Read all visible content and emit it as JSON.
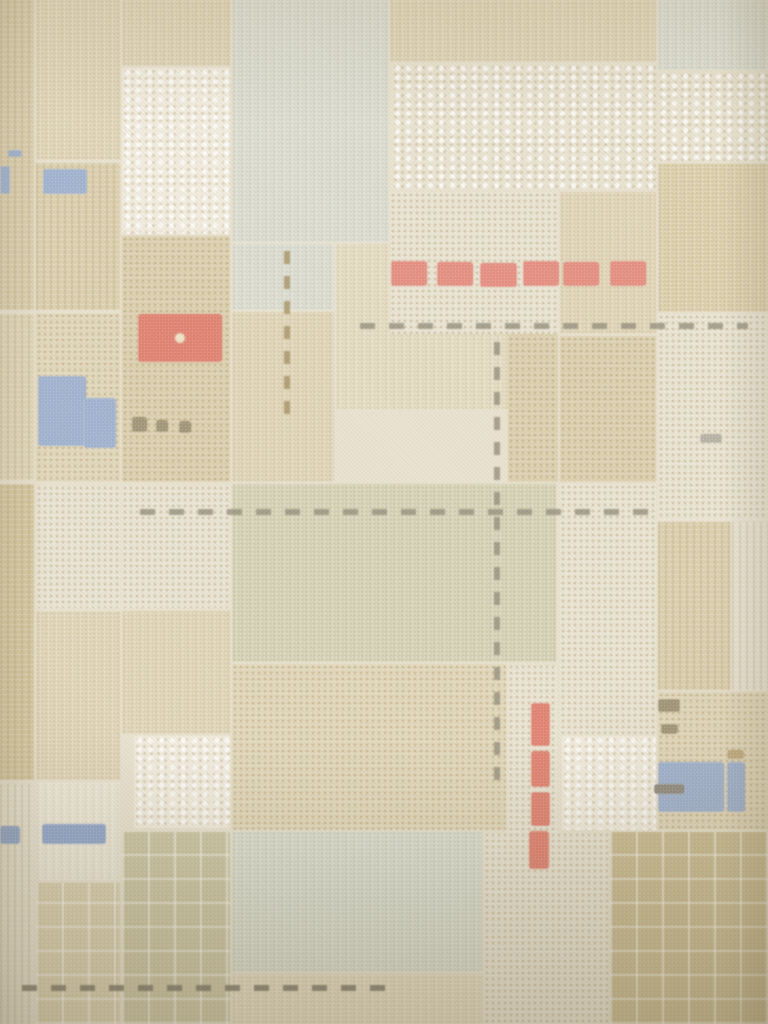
{
  "meta": {
    "subject": "vintage patchwork plaid wallpaper photograph with stitched accent motifs"
  },
  "palette": {
    "base": "#e9e2d0",
    "tan": "#dbcfae",
    "tan_light": "#e0d6b9",
    "olive": "#d6c8a1",
    "olive_dark": "#cfc29b",
    "beige": "#ded5b8",
    "sage": "#d0cbac",
    "bluegray": "#d6d8cb",
    "bluegreen": "#d3d7c8",
    "cream": "#e9e3d2",
    "white": "#f1ecdf",
    "red": "#df7868",
    "red_deep": "#da6a57",
    "blue": "#8ea3c6",
    "blue_deep": "#7d95bf",
    "stitch_gray": "#96907e",
    "stitch_dark": "#7b7566",
    "stitch_brown": "#a79366",
    "olive_mark": "#8d805d",
    "tan_mark": "#b49a66",
    "gray_mark": "#a7a294"
  },
  "scene": {
    "width": 768,
    "height": 1024,
    "background": "base"
  },
  "patches": [
    {
      "name": "left-column-top",
      "c": "tan",
      "tx": "stripes",
      "x": 0,
      "y": 0,
      "w": 34,
      "h": 310
    },
    {
      "name": "left-column-mid",
      "c": "tan_light",
      "tx": "stripes",
      "x": 0,
      "y": 314,
      "w": 34,
      "h": 166
    },
    {
      "name": "left-column-olive",
      "c": "olive",
      "tx": "stripes",
      "x": 0,
      "y": 484,
      "w": 34,
      "h": 296
    },
    {
      "name": "left-column-bottom",
      "c": "cream",
      "tx": "stripes",
      "x": 0,
      "y": 784,
      "w": 34,
      "h": 240
    },
    {
      "name": "col1-top",
      "c": "tan",
      "tx": "grid",
      "x": 36,
      "y": 0,
      "w": 84,
      "h": 160
    },
    {
      "name": "col1-blue-row",
      "c": "tan",
      "tx": "stripes",
      "x": 36,
      "y": 163,
      "w": 84,
      "h": 147
    },
    {
      "name": "col1-mid",
      "c": "tan_light",
      "tx": "dots",
      "x": 36,
      "y": 313,
      "w": 84,
      "h": 169
    },
    {
      "name": "col1-cream",
      "c": "cream",
      "tx": "dots",
      "x": 36,
      "y": 485,
      "w": 84,
      "h": 123
    },
    {
      "name": "col1-low",
      "c": "tan",
      "tx": "grid",
      "x": 36,
      "y": 611,
      "w": 84,
      "h": 169
    },
    {
      "name": "col1-pale",
      "c": "cream",
      "tx": "grid",
      "x": 36,
      "y": 783,
      "w": 84,
      "h": 97
    },
    {
      "name": "col1-bottom",
      "c": "beige",
      "tx": "plaid",
      "x": 36,
      "y": 883,
      "w": 84,
      "h": 141
    },
    {
      "name": "col2-top",
      "c": "tan",
      "tx": "grid",
      "x": 122,
      "y": 0,
      "w": 108,
      "h": 66
    },
    {
      "name": "col2-lace",
      "c": "white",
      "tx": "lace",
      "x": 122,
      "y": 68,
      "w": 108,
      "h": 166
    },
    {
      "name": "col2-mid",
      "c": "tan",
      "tx": "dots",
      "x": 122,
      "y": 236,
      "w": 108,
      "h": 246
    },
    {
      "name": "col2-cream",
      "c": "cream",
      "tx": "dots",
      "x": 122,
      "y": 485,
      "w": 108,
      "h": 123
    },
    {
      "name": "col2-low",
      "c": "tan",
      "tx": "grid",
      "x": 122,
      "y": 611,
      "w": 108,
      "h": 123
    },
    {
      "name": "col2-white-lace",
      "c": "white",
      "tx": "lace",
      "x": 134,
      "y": 736,
      "w": 96,
      "h": 92
    },
    {
      "name": "col2-bottom",
      "c": "sage",
      "tx": "plaid",
      "x": 122,
      "y": 832,
      "w": 108,
      "h": 192
    },
    {
      "name": "top-bluegray",
      "c": "bluegray",
      "tx": "grid",
      "x": 232,
      "y": 0,
      "w": 156,
      "h": 242
    },
    {
      "name": "bluegray-ext",
      "c": "bluegray",
      "tx": "grid",
      "x": 232,
      "y": 244,
      "w": 102,
      "h": 66
    },
    {
      "name": "mid-tan-row",
      "c": "tan_light",
      "tx": "grid",
      "x": 336,
      "y": 244,
      "w": 172,
      "h": 166
    },
    {
      "name": "mid-tan-left",
      "c": "tan",
      "tx": "grid",
      "x": 232,
      "y": 312,
      "w": 102,
      "h": 170
    },
    {
      "name": "sage-big",
      "c": "sage",
      "tx": "grid",
      "x": 232,
      "y": 484,
      "w": 324,
      "h": 178
    },
    {
      "name": "mid-tan-low",
      "c": "tan_light",
      "tx": "dots",
      "x": 232,
      "y": 664,
      "w": 274,
      "h": 166
    },
    {
      "name": "strip-mid",
      "c": "tan",
      "tx": "dots",
      "x": 508,
      "y": 312,
      "w": 50,
      "h": 170
    },
    {
      "name": "strip-mid-low",
      "c": "cream",
      "tx": "dots",
      "x": 508,
      "y": 664,
      "w": 50,
      "h": 216
    },
    {
      "name": "col4-top",
      "c": "tan",
      "tx": "grid",
      "x": 560,
      "y": 192,
      "w": 96,
      "h": 142
    },
    {
      "name": "col4-mid",
      "c": "tan",
      "tx": "dots",
      "x": 560,
      "y": 336,
      "w": 96,
      "h": 146
    },
    {
      "name": "col4-cream",
      "c": "cream",
      "tx": "dots",
      "x": 560,
      "y": 484,
      "w": 96,
      "h": 250
    },
    {
      "name": "col4-lace",
      "c": "white",
      "tx": "lace",
      "x": 562,
      "y": 736,
      "w": 94,
      "h": 94
    },
    {
      "name": "bottom-bluegreen",
      "c": "bluegreen",
      "tx": "grid",
      "x": 232,
      "y": 832,
      "w": 250,
      "h": 140
    },
    {
      "name": "bottom-strip",
      "c": "tan_light",
      "tx": "grid",
      "x": 232,
      "y": 974,
      "w": 250,
      "h": 50
    },
    {
      "name": "bottom-cream",
      "c": "cream",
      "tx": "dots",
      "x": 484,
      "y": 832,
      "w": 124,
      "h": 192
    },
    {
      "name": "red-row-bg",
      "c": "cream",
      "tx": "dots",
      "x": 390,
      "y": 192,
      "w": 168,
      "h": 142
    },
    {
      "name": "top-tan-row",
      "c": "tan",
      "tx": "grid",
      "x": 390,
      "y": 0,
      "w": 266,
      "h": 62
    },
    {
      "name": "top-lace",
      "c": "cream",
      "tx": "lace",
      "x": 392,
      "y": 64,
      "w": 264,
      "h": 126
    },
    {
      "name": "topright-corner",
      "c": "bluegray",
      "tx": "grid",
      "x": 658,
      "y": 0,
      "w": 110,
      "h": 70
    },
    {
      "name": "right-lace-1",
      "c": "cream",
      "tx": "lace",
      "x": 658,
      "y": 72,
      "w": 110,
      "h": 90
    },
    {
      "name": "right-olive",
      "c": "olive",
      "tx": "grid",
      "x": 658,
      "y": 164,
      "w": 110,
      "h": 148
    },
    {
      "name": "right-lace-2",
      "c": "cream",
      "tx": "dots",
      "x": 658,
      "y": 314,
      "w": 110,
      "h": 206
    },
    {
      "name": "right-strip-1",
      "c": "tan",
      "tx": "stripes",
      "x": 658,
      "y": 522,
      "w": 72,
      "h": 168
    },
    {
      "name": "right-strip-2",
      "c": "cream",
      "tx": "stripes",
      "x": 732,
      "y": 522,
      "w": 36,
      "h": 168
    },
    {
      "name": "right-blue-patch",
      "c": "tan_light",
      "tx": "dots",
      "x": 658,
      "y": 692,
      "w": 110,
      "h": 138
    },
    {
      "name": "bottomright-corner",
      "c": "olive_dark",
      "tx": "plaid",
      "x": 610,
      "y": 832,
      "w": 158,
      "h": 192
    }
  ],
  "motifs": [
    {
      "name": "red-stitch-block-1",
      "c": "red",
      "x": 391,
      "y": 261,
      "w": 36,
      "h": 25
    },
    {
      "name": "red-stitch-block-2",
      "c": "red",
      "x": 437,
      "y": 262,
      "w": 36,
      "h": 24
    },
    {
      "name": "red-stitch-block-3",
      "c": "red",
      "x": 480,
      "y": 263,
      "w": 37,
      "h": 24
    },
    {
      "name": "red-stitch-block-4",
      "c": "red",
      "x": 523,
      "y": 261,
      "w": 36,
      "h": 25
    },
    {
      "name": "red-stitch-block-5",
      "c": "red",
      "x": 563,
      "y": 262,
      "w": 36,
      "h": 24
    },
    {
      "name": "red-stitch-block-6",
      "c": "red",
      "x": 610,
      "y": 261,
      "w": 36,
      "h": 25
    },
    {
      "name": "red-stitch-box",
      "c": "red_deep",
      "x": 138,
      "y": 314,
      "w": 84,
      "h": 48,
      "cls": "m-center-dot"
    },
    {
      "name": "red-stitch-bar-1",
      "c": "red_deep",
      "x": 531,
      "y": 703,
      "w": 19,
      "h": 43
    },
    {
      "name": "red-stitch-bar-2",
      "c": "red_deep",
      "x": 531,
      "y": 751,
      "w": 19,
      "h": 36
    },
    {
      "name": "red-stitch-bar-3",
      "c": "red_deep",
      "x": 531,
      "y": 792,
      "w": 19,
      "h": 34
    },
    {
      "name": "red-stitch-bar-4",
      "c": "red_deep",
      "x": 529,
      "y": 831,
      "w": 20,
      "h": 38
    },
    {
      "name": "blue-stitch-dash",
      "c": "blue",
      "x": 8,
      "y": 150,
      "w": 14,
      "h": 7
    },
    {
      "name": "blue-stitch-sliver",
      "c": "blue",
      "x": 0,
      "y": 166,
      "w": 10,
      "h": 28
    },
    {
      "name": "blue-stitch-block-topleft",
      "c": "blue",
      "x": 43,
      "y": 169,
      "w": 44,
      "h": 25
    },
    {
      "name": "blue-block-l-main",
      "c": "blue",
      "x": 38,
      "y": 376,
      "w": 48,
      "h": 70
    },
    {
      "name": "blue-block-l-ext",
      "c": "blue",
      "x": 84,
      "y": 398,
      "w": 32,
      "h": 50
    },
    {
      "name": "blue-band-left",
      "c": "blue_deep",
      "x": 0,
      "y": 826,
      "w": 20,
      "h": 18
    },
    {
      "name": "blue-band-main",
      "c": "blue_deep",
      "x": 42,
      "y": 824,
      "w": 64,
      "h": 20
    },
    {
      "name": "blue-block-right",
      "c": "blue",
      "x": 658,
      "y": 762,
      "w": 66,
      "h": 50
    },
    {
      "name": "blue-strip-right",
      "c": "blue",
      "x": 727,
      "y": 762,
      "w": 18,
      "h": 50
    },
    {
      "name": "olive-mark-1",
      "c": "olive_mark",
      "x": 132,
      "y": 417,
      "w": 15,
      "h": 15
    },
    {
      "name": "olive-mark-2",
      "c": "olive_mark",
      "x": 156,
      "y": 420,
      "w": 12,
      "h": 12
    },
    {
      "name": "olive-mark-3",
      "c": "olive_mark",
      "x": 179,
      "y": 421,
      "w": 12,
      "h": 12
    },
    {
      "name": "olive-mark-4",
      "c": "olive_mark",
      "x": 658,
      "y": 699,
      "w": 22,
      "h": 13
    },
    {
      "name": "olive-mark-5",
      "c": "olive_mark",
      "x": 661,
      "y": 724,
      "w": 17,
      "h": 10
    },
    {
      "name": "tan-mark",
      "c": "tan_mark",
      "x": 727,
      "y": 750,
      "w": 17,
      "h": 9
    },
    {
      "name": "dark-dash",
      "c": "stitch_dark",
      "x": 654,
      "y": 784,
      "w": 30,
      "h": 10
    },
    {
      "name": "gray-mark",
      "c": "gray_mark",
      "x": 700,
      "y": 434,
      "w": 22,
      "h": 9
    }
  ],
  "stitches": [
    {
      "name": "stitch-line-h1",
      "o": "h",
      "c": "stitch_gray",
      "x": 360,
      "y": 323,
      "len": 388
    },
    {
      "name": "stitch-line-h2",
      "o": "h",
      "c": "stitch_gray",
      "x": 140,
      "y": 509,
      "len": 518
    },
    {
      "name": "stitch-line-h3",
      "o": "h",
      "c": "stitch_dark",
      "x": 22,
      "y": 985,
      "len": 366
    },
    {
      "name": "stitch-line-v1",
      "o": "v",
      "c": "stitch_gray",
      "x": 494,
      "y": 330,
      "len": 450
    },
    {
      "name": "stitch-line-v2",
      "o": "v",
      "c": "stitch_brown",
      "x": 284,
      "y": 246,
      "len": 168
    }
  ]
}
